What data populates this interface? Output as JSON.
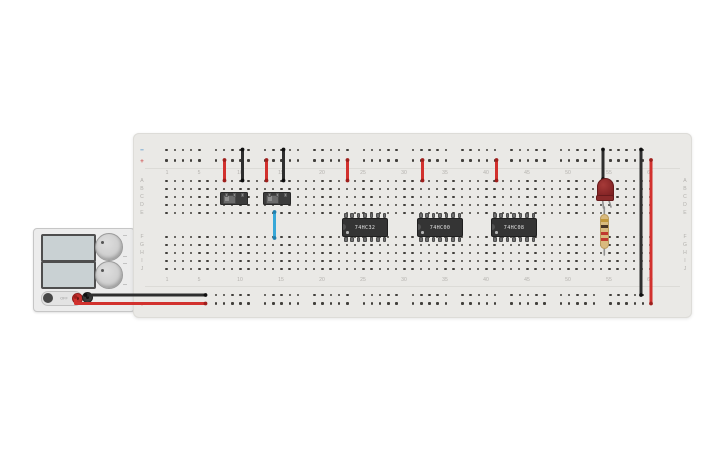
{
  "canvas": {
    "width": 725,
    "height": 453,
    "background": "#ffffff"
  },
  "power_supply": {
    "toggle_label": "OFF",
    "display_top_value": "",
    "display_bottom_value": "",
    "terminals": [
      "positive-red",
      "negative-black"
    ]
  },
  "breadboard": {
    "columns": 60,
    "column_numbers": [
      1,
      5,
      10,
      15,
      20,
      25,
      30,
      35,
      40,
      45,
      50,
      55,
      60
    ],
    "row_letters_top": [
      "A",
      "B",
      "C",
      "D",
      "E"
    ],
    "row_letters_bottom": [
      "F",
      "G",
      "H",
      "I",
      "J"
    ],
    "rail_negative_symbol": "−",
    "rail_positive_symbol": "+"
  },
  "components": {
    "ics": [
      {
        "label": "74HC32"
      },
      {
        "label": "74HC00"
      },
      {
        "label": "74HC08"
      }
    ],
    "switches": [
      {
        "name": "slide-switch-1",
        "position": "left"
      },
      {
        "name": "slide-switch-2",
        "position": "left"
      }
    ],
    "led": {
      "color": "red"
    },
    "resistor": {
      "bands": [
        "gold",
        "brown",
        "red",
        "red"
      ]
    }
  },
  "colors": {
    "wire_red": "#d2312e",
    "wire_black": "#2e2e2e",
    "wire_blue": "#38a8d8",
    "cap_red": "#9e1f1c",
    "cap_black": "#0f0f0f",
    "cap_blue": "#1f7fae",
    "rail_negative": "#4a90c8",
    "rail_positive": "#d05555",
    "band_gold": "#c2973a",
    "band_brown": "#4a3524",
    "band_red": "#c03a30"
  },
  "wires": [
    {
      "name": "wire-psu-negative-to-bottom-rail",
      "color": "black",
      "points": [
        [
          85.5,
          295
        ],
        [
          205.5,
          295
        ]
      ]
    },
    {
      "name": "wire-psu-positive-to-bottom-rail",
      "color": "red",
      "points": [
        [
          75.5,
          297
        ],
        [
          75.5,
          303.5
        ],
        [
          205.5,
          303.5
        ]
      ]
    },
    {
      "name": "wire-plus-rail-to-a8",
      "color": "red",
      "points": [
        [
          224.5,
          160
        ],
        [
          224.5,
          180.5
        ]
      ]
    },
    {
      "name": "wire-minus-rail-to-a10",
      "color": "black",
      "points": [
        [
          242.5,
          149.5
        ],
        [
          242.5,
          180.5
        ]
      ]
    },
    {
      "name": "wire-plus-rail-to-a13",
      "color": "red",
      "points": [
        [
          266.5,
          160
        ],
        [
          266.5,
          180.5
        ]
      ]
    },
    {
      "name": "wire-minus-rail-to-a15",
      "color": "black",
      "points": [
        [
          283.5,
          149.5
        ],
        [
          283.5,
          180.5
        ]
      ]
    },
    {
      "name": "wire-plus-rail-to-a23",
      "color": "red",
      "points": [
        [
          347.5,
          160
        ],
        [
          347.5,
          180.5
        ]
      ]
    },
    {
      "name": "wire-plus-rail-to-a32",
      "color": "red",
      "points": [
        [
          422.5,
          160
        ],
        [
          422.5,
          180.5
        ]
      ]
    },
    {
      "name": "wire-plus-rail-to-a41",
      "color": "red",
      "points": [
        [
          496.5,
          160
        ],
        [
          496.5,
          180.5
        ]
      ]
    },
    {
      "name": "wire-minus-rail-to-led",
      "color": "black",
      "points": [
        [
          603,
          149.5
        ],
        [
          603,
          179
        ]
      ]
    },
    {
      "name": "wire-right-black-jumper",
      "color": "black",
      "points": [
        [
          641,
          149.5
        ],
        [
          641,
          295
        ]
      ]
    },
    {
      "name": "wire-right-red-jumper",
      "color": "red",
      "points": [
        [
          651,
          160
        ],
        [
          651,
          303.5
        ]
      ]
    },
    {
      "name": "wire-switch-to-f14",
      "color": "blue",
      "points": [
        [
          274.5,
          212
        ],
        [
          274.5,
          238
        ]
      ]
    }
  ],
  "leads": [
    {
      "name": "led-leg-left",
      "points": [
        [
          602.5,
          199
        ],
        [
          603.5,
          208
        ]
      ]
    },
    {
      "name": "led-leg-right",
      "points": [
        [
          608.5,
          199
        ],
        [
          611,
          207
        ]
      ]
    },
    {
      "name": "resistor-lead-top",
      "points": [
        [
          604.3,
          207
        ],
        [
          604.3,
          216
        ]
      ]
    },
    {
      "name": "resistor-lead-bottom",
      "points": [
        [
          604.3,
          246
        ],
        [
          604.3,
          255
        ]
      ]
    }
  ]
}
